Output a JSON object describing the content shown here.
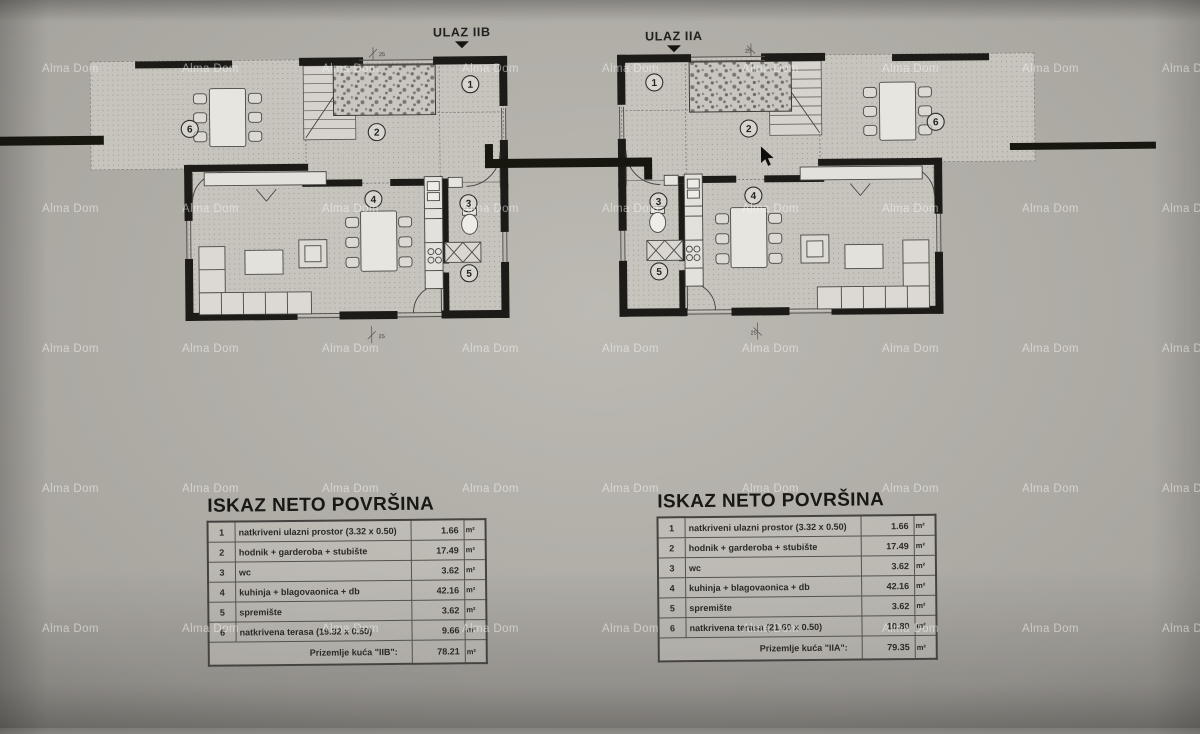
{
  "watermark": "Alma Dom",
  "plans": [
    {
      "entrance_label": "ULAZ IIB",
      "rooms": [
        "1",
        "2",
        "3",
        "4",
        "5",
        "6"
      ],
      "dim": "25"
    },
    {
      "entrance_label": "ULAZ IIA",
      "rooms": [
        "1",
        "2",
        "3",
        "4",
        "5",
        "6"
      ],
      "dim": "25"
    }
  ],
  "tables": [
    {
      "title": "ISKAZ NETO POVRŠINA",
      "unit": "m²",
      "rows": [
        [
          "1",
          "natkriveni ulazni prostor (3.32 x 0.50)",
          "1.66"
        ],
        [
          "2",
          "hodnik + garderoba + stubište",
          "17.49"
        ],
        [
          "3",
          "wc",
          "3.62"
        ],
        [
          "4",
          "kuhinja + blagovaonica + db",
          "42.16"
        ],
        [
          "5",
          "spremište",
          "3.62"
        ],
        [
          "6",
          "natkrivena terasa (19.32 x 0.50)",
          "9.66"
        ]
      ],
      "footer_label": "Prizemlje kuća \"IIB\":",
      "footer_value": "78.21"
    },
    {
      "title": "ISKAZ NETO POVRŠINA",
      "unit": "m²",
      "rows": [
        [
          "1",
          "natkriveni ulazni prostor (3.32 x 0.50)",
          "1.66"
        ],
        [
          "2",
          "hodnik + garderoba + stubište",
          "17.49"
        ],
        [
          "3",
          "wc",
          "3.62"
        ],
        [
          "4",
          "kuhinja + blagovaonica + db",
          "42.16"
        ],
        [
          "5",
          "spremište",
          "3.62"
        ],
        [
          "6",
          "natkrivena terasa (21.60 x 0.50)",
          "10.80"
        ]
      ],
      "footer_label": "Prizemlje kuća \"IIA\":",
      "footer_value": "79.35"
    }
  ]
}
